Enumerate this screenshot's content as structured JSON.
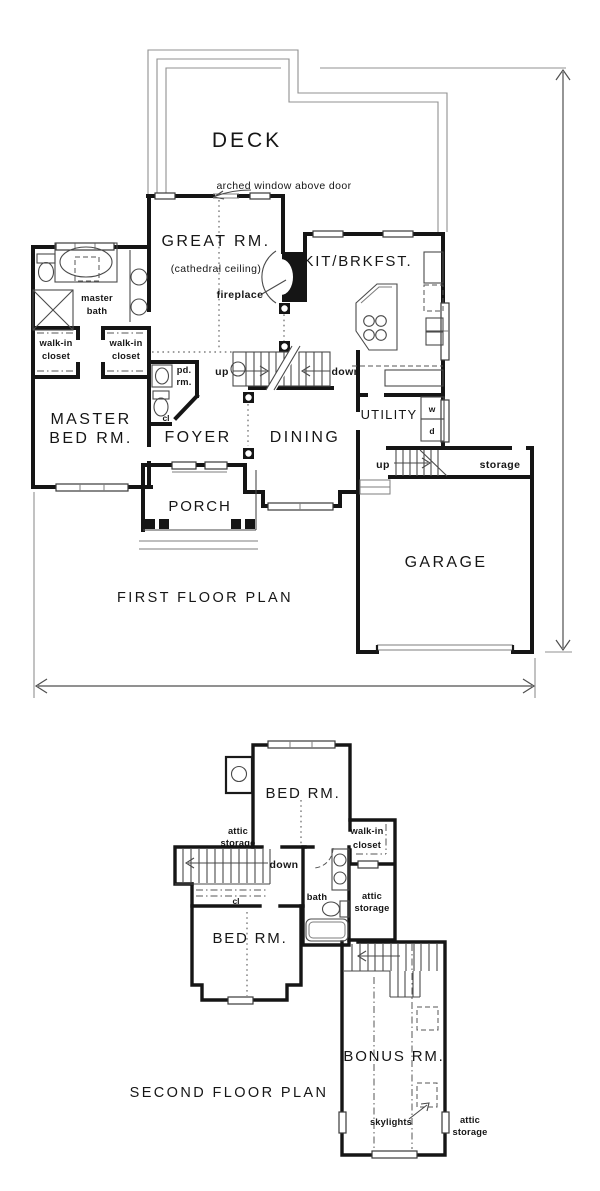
{
  "first_floor": {
    "caption": "FIRST FLOOR PLAN",
    "labels": {
      "deck": "DECK",
      "arched_window_note": "arched window above door",
      "great_room": "GREAT RM.",
      "cathedral_note": "(cathedral ceiling)",
      "fireplace": "fireplace",
      "kitchen": "KIT/BRKFST.",
      "master_bath": [
        "master",
        "bath"
      ],
      "walk_in_closet_left": [
        "walk-in",
        "closet"
      ],
      "walk_in_closet_right": [
        "walk-in",
        "closet"
      ],
      "master_bed": [
        "MASTER",
        "BED RM."
      ],
      "powder_room": [
        "pd.",
        "rm."
      ],
      "closet": "cl",
      "stairs_up": "up",
      "stairs_down": "down",
      "foyer": "FOYER",
      "dining": "DINING",
      "utility": "UTILITY",
      "washer": "w",
      "dryer": "d",
      "garage_stairs_up": "up",
      "storage": "storage",
      "porch": "PORCH",
      "garage": "GARAGE"
    }
  },
  "second_floor": {
    "caption": "SECOND FLOOR PLAN",
    "labels": {
      "bedroom_upper": "BED RM.",
      "attic_storage_left": [
        "attic",
        "storage"
      ],
      "walk_in_closet": [
        "walk-in",
        "closet"
      ],
      "stairs_down": "down",
      "closet": "cl",
      "bath": "bath",
      "attic_storage_mid": [
        "attic",
        "storage"
      ],
      "bedroom_lower": "BED RM.",
      "bonus_room": "BONUS RM.",
      "skylights": "skylights",
      "attic_storage_bonus": [
        "attic",
        "storage"
      ]
    }
  }
}
